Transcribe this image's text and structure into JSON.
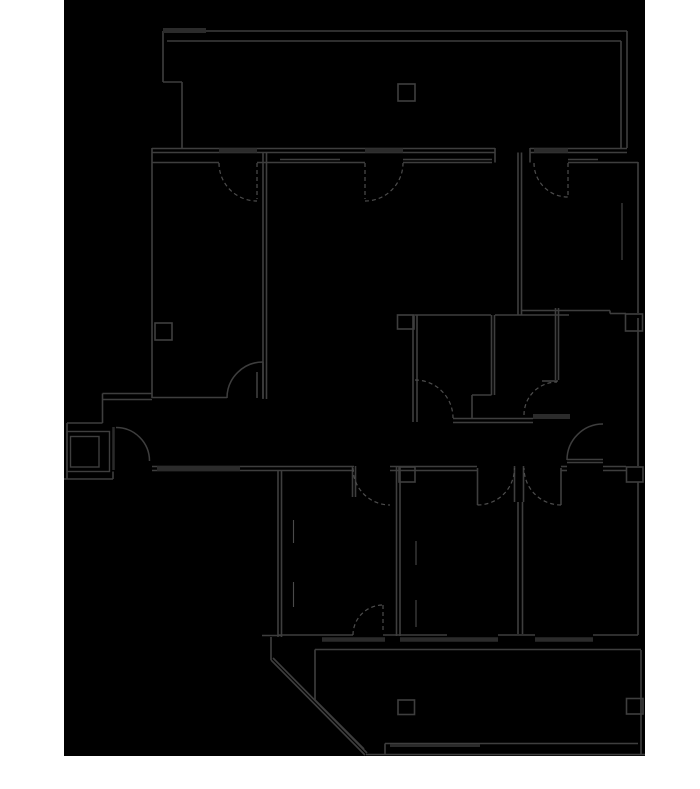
{
  "canvas": {
    "width": 700,
    "height": 789,
    "page_bg": "#ffffff"
  },
  "plan_area": {
    "x": 64,
    "y": 0,
    "width": 581,
    "height": 756,
    "fill": "#000000"
  },
  "colors": {
    "wall": "#3e3e3e",
    "wall_light": "#4a4a4a",
    "thick": "#2b2b2b",
    "dashed": "#4d4d4d"
  },
  "layers": {
    "walls": [
      [
        163,
        31,
        627,
        31
      ],
      [
        167,
        41,
        621,
        41
      ],
      [
        163,
        31,
        163,
        82
      ],
      [
        163,
        82,
        182,
        82
      ],
      [
        182,
        82,
        182,
        148
      ],
      [
        627,
        31,
        627,
        148
      ],
      [
        621,
        41,
        621,
        148
      ],
      [
        152,
        148.5,
        495,
        148.5
      ],
      [
        530,
        148.5,
        627,
        148.5
      ],
      [
        152,
        152.5,
        495,
        152.5
      ],
      [
        530,
        152.5,
        627,
        152.5
      ],
      [
        495,
        148,
        495,
        162.5
      ],
      [
        530,
        148,
        530,
        162.5
      ],
      [
        152,
        162.5,
        219,
        162.5
      ],
      [
        257,
        162.5,
        280,
        162.5
      ],
      [
        340,
        162.5,
        365,
        162.5
      ],
      [
        598,
        162.5,
        638,
        162.5
      ],
      [
        280,
        159.5,
        340,
        159.5
      ],
      [
        280,
        162.5,
        340,
        162.5
      ],
      [
        403,
        159.5,
        492,
        159.5
      ],
      [
        403,
        162.5,
        492,
        162.5
      ],
      [
        568,
        159.5,
        598,
        159.5
      ],
      [
        568,
        162.5,
        598,
        162.5
      ],
      [
        152,
        148,
        152,
        398
      ],
      [
        263,
        152.5,
        263,
        399
      ],
      [
        266.5,
        152.5,
        266.5,
        399
      ],
      [
        152,
        397.5,
        227,
        397.5
      ],
      [
        257,
        372,
        257,
        398
      ],
      [
        263,
        362,
        263,
        398
      ],
      [
        102.5,
        393.5,
        152,
        393.5
      ],
      [
        102.5,
        399.5,
        152,
        399.5
      ],
      [
        102.5,
        393.5,
        102.5,
        423
      ],
      [
        67,
        423,
        102.5,
        423
      ],
      [
        67,
        423,
        67,
        479
      ],
      [
        64,
        479,
        113,
        479
      ],
      [
        113,
        471.5,
        113,
        479
      ],
      [
        518,
        152.5,
        518,
        315
      ],
      [
        521.5,
        152.5,
        521.5,
        315
      ],
      [
        638,
        162,
        638,
        313
      ],
      [
        521,
        310.5,
        610,
        310.5
      ],
      [
        610,
        310.5,
        610,
        313.5
      ],
      [
        610,
        313.5,
        626,
        313.5
      ],
      [
        638,
        318,
        638,
        466
      ],
      [
        415,
        315,
        491,
        315
      ],
      [
        495,
        315,
        569,
        315
      ],
      [
        413,
        315,
        413,
        422
      ],
      [
        417,
        315,
        417,
        422
      ],
      [
        491.5,
        315,
        491.5,
        395
      ],
      [
        494.5,
        315,
        494.5,
        395
      ],
      [
        472,
        395,
        491.5,
        395
      ],
      [
        472,
        395,
        472,
        418
      ],
      [
        555.5,
        308,
        555.5,
        380
      ],
      [
        558.5,
        308,
        558.5,
        380
      ],
      [
        542,
        381,
        558,
        381
      ],
      [
        453,
        418.5,
        533,
        418.5
      ],
      [
        453,
        422.5,
        533,
        422.5
      ],
      [
        152,
        466.5,
        354,
        466.5
      ],
      [
        152,
        470.5,
        354,
        470.5
      ],
      [
        390,
        466.5,
        477,
        466.5
      ],
      [
        390,
        470.5,
        477,
        470.5
      ],
      [
        514.5,
        466,
        514.5,
        502
      ],
      [
        523.5,
        466,
        523.5,
        502
      ],
      [
        561,
        466.5,
        567,
        466.5
      ],
      [
        561,
        470.5,
        567,
        470.5
      ],
      [
        603,
        466.5,
        626,
        466.5
      ],
      [
        603,
        470.5,
        626,
        470.5
      ],
      [
        352.5,
        466,
        352.5,
        497
      ],
      [
        355.5,
        466,
        355.5,
        497
      ],
      [
        477.5,
        468,
        477.5,
        505
      ],
      [
        561,
        468,
        561,
        505
      ],
      [
        567,
        459.5,
        603,
        459.5
      ],
      [
        567,
        462.5,
        603,
        462.5
      ],
      [
        278,
        470,
        278,
        637
      ],
      [
        281.5,
        470,
        281.5,
        637
      ],
      [
        396.5,
        466,
        396.5,
        636
      ],
      [
        400,
        466,
        400,
        636
      ],
      [
        518,
        502,
        518,
        634
      ],
      [
        522.5,
        502,
        522.5,
        634
      ],
      [
        638,
        482,
        638,
        635
      ],
      [
        278,
        635,
        353,
        635
      ],
      [
        383,
        635,
        447,
        635
      ],
      [
        498,
        635,
        535,
        635
      ],
      [
        593,
        635,
        638,
        635
      ],
      [
        262,
        635.5,
        281,
        635.5
      ],
      [
        315,
        649.5,
        641,
        649.5
      ],
      [
        315,
        649.5,
        315,
        700
      ],
      [
        271,
        637,
        271,
        660
      ],
      [
        271,
        660,
        365,
        755
      ],
      [
        273,
        658,
        367,
        753
      ],
      [
        315,
        700,
        364,
        749
      ],
      [
        385,
        743.5,
        638,
        743.5
      ],
      [
        366,
        754.5,
        645,
        754.5
      ],
      [
        385,
        743.5,
        385,
        754.5
      ],
      [
        641,
        650,
        641,
        754.5
      ]
    ],
    "details": [
      [
        622,
        203,
        622,
        260
      ],
      [
        416,
        541,
        416,
        565
      ],
      [
        416,
        600,
        416,
        627
      ],
      [
        293.5,
        520,
        293.5,
        543
      ],
      [
        293.5,
        582,
        293.5,
        607
      ]
    ],
    "thick_bars": [
      [
        163,
        30.5,
        206,
        30.5,
        5
      ],
      [
        219,
        150.5,
        257,
        150.5,
        4.5
      ],
      [
        365,
        150.5,
        403,
        150.5,
        4.5
      ],
      [
        534,
        150.5,
        568,
        150.5,
        4.5
      ],
      [
        157,
        468.5,
        240,
        468.5,
        5
      ],
      [
        533,
        416.5,
        570,
        416.5,
        5
      ],
      [
        322,
        639.5,
        385,
        639.5,
        4.5
      ],
      [
        400,
        639.5,
        498,
        639.5,
        4.5
      ],
      [
        535,
        639.5,
        593,
        639.5,
        4.5
      ],
      [
        390,
        745.5,
        480,
        745.5,
        3
      ],
      [
        113.5,
        427,
        113.5,
        470,
        2.5
      ]
    ],
    "arcs_solid": [
      "M227,398 A36,36 0 0 1 263,362",
      "M116,427.5 A33.5,33.5 0 0 1 149.5,461",
      "M567,460 A36,36 0 0 1 603,424"
    ],
    "arcs_dashed": [
      "M219,163 A38,38 0 0 0 257,201",
      "M365,201 A38,38 0 0 0 403,163",
      "M534,163 A34,34 0 0 0 568,197",
      "M415,380 A38,38 0 0 1 453,418",
      "M524,415 A33,33 0 0 1 557,382",
      "M353,468 A37,37 0 0 0 390,505",
      "M477.5,505 A37,37 0 0 0 514.5,468",
      "M561,505 A37,37 0 0 1 524,468",
      "M353,635 A30,30 0 0 1 383,605"
    ],
    "leaves_dashed": [
      [
        257,
        163,
        257,
        199
      ],
      [
        365,
        163,
        365,
        199
      ],
      [
        568,
        163,
        568,
        197
      ],
      [
        383,
        605,
        383,
        632
      ]
    ],
    "columns": [
      [
        398,
        84,
        17,
        17
      ],
      [
        155,
        323,
        17,
        17
      ],
      [
        397.5,
        315,
        16.5,
        14
      ],
      [
        625.5,
        314,
        17,
        17
      ],
      [
        399,
        467,
        16,
        15
      ],
      [
        626.5,
        467,
        16.5,
        15
      ],
      [
        398,
        700,
        16.5,
        14.5
      ],
      [
        626.5,
        698.5,
        16.5,
        15.5
      ]
    ],
    "boxes": [
      [
        67,
        431.5,
        42.5,
        40
      ],
      [
        70.5,
        436.5,
        28.5,
        30.5
      ]
    ]
  }
}
